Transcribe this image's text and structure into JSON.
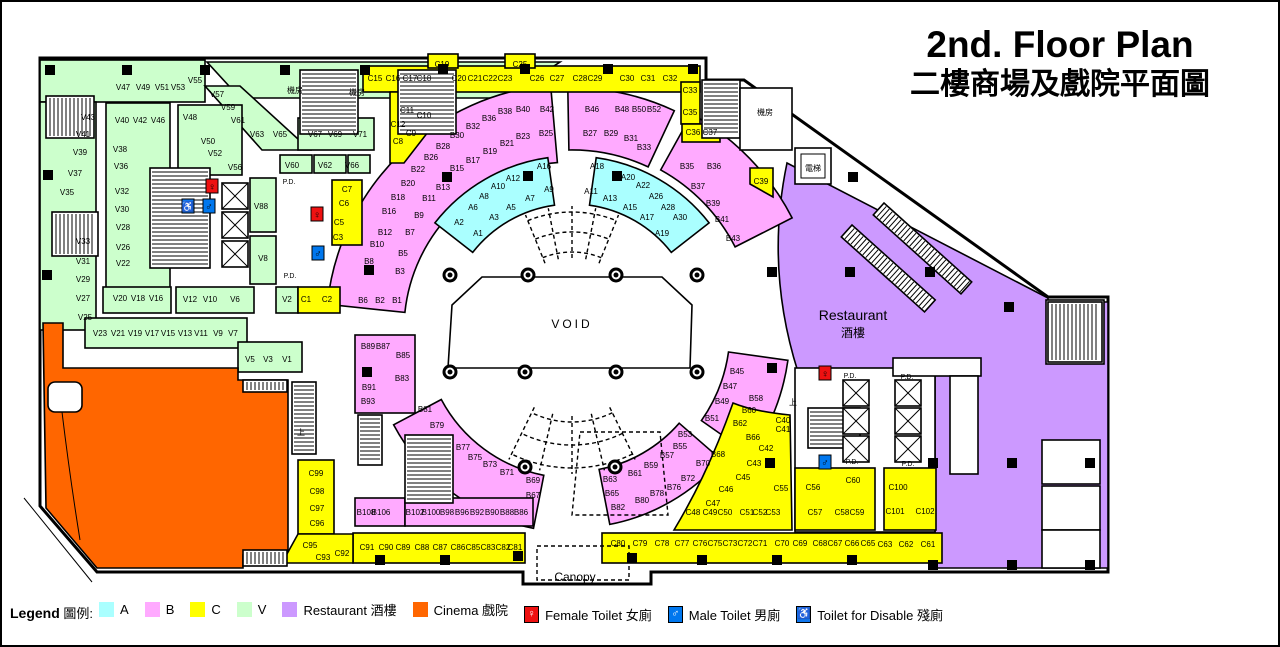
{
  "title": {
    "line1": "2nd. Floor Plan",
    "line2": "二樓商場及戲院平面圖"
  },
  "plan": {
    "void_label": "VOID",
    "canopy_label": "Canopy",
    "restaurant_en": "Restaurant",
    "restaurant_zh": "酒樓",
    "pd_text": "P.D."
  },
  "colors": {
    "a_cyan": "#aaffff",
    "b_pink": "#ffaaff",
    "c_yellow": "#ffff00",
    "v_green": "#ccffcc",
    "restaurant_purple": "#cc99ff",
    "cinema_orange": "#ff6600",
    "female_red": "#ee1111",
    "male_blue": "#0077ee",
    "disabled_blue": "#1177ee"
  },
  "legend": {
    "title_en": "Legend",
    "title_zh": "圖例:",
    "items": [
      {
        "label": "A",
        "type": "color",
        "swatch": "#aaffff"
      },
      {
        "label": "B",
        "type": "color",
        "swatch": "#ffaaff"
      },
      {
        "label": "C",
        "type": "color",
        "swatch": "#ffff00"
      },
      {
        "label": "V",
        "type": "color",
        "swatch": "#ccffcc"
      },
      {
        "label": "Restaurant 酒樓",
        "type": "color",
        "swatch": "#cc99ff"
      },
      {
        "label": "Cinema 戲院",
        "type": "color",
        "swatch": "#ff6600"
      },
      {
        "label": "Female Toilet 女廁",
        "type": "icon",
        "icon": "female-toilet",
        "swatch": "#ee1111"
      },
      {
        "label": "Male Toilet 男廁",
        "type": "icon",
        "icon": "male-toilet",
        "swatch": "#0077ee"
      },
      {
        "label": "Toilet for Disable 殘廁",
        "type": "icon",
        "icon": "disabled-toilet",
        "swatch": "#1177ee"
      }
    ]
  },
  "unit_labels": {
    "V": [
      [
        "V43",
        88,
        117
      ],
      [
        "V41",
        83,
        134
      ],
      [
        "V39",
        80,
        152
      ],
      [
        "V37",
        75,
        173
      ],
      [
        "V35",
        67,
        192
      ],
      [
        "V33",
        83,
        241
      ],
      [
        "V31",
        83,
        261
      ],
      [
        "V29",
        83,
        279
      ],
      [
        "V27",
        83,
        298
      ],
      [
        "V25",
        85,
        317
      ],
      [
        "V47",
        123,
        87
      ],
      [
        "V49",
        143,
        87
      ],
      [
        "V51",
        162,
        87
      ],
      [
        "V53",
        178,
        87
      ],
      [
        "V55",
        195,
        80
      ],
      [
        "V57",
        217,
        94
      ],
      [
        "V59",
        228,
        107
      ],
      [
        "V61",
        238,
        120
      ],
      [
        "V63",
        257,
        134
      ],
      [
        "V65",
        280,
        134
      ],
      [
        "V67",
        315,
        134
      ],
      [
        "V69",
        335,
        134
      ],
      [
        "V71",
        360,
        134
      ],
      [
        "V40",
        122,
        120
      ],
      [
        "V42",
        140,
        120
      ],
      [
        "V46",
        158,
        120
      ],
      [
        "V48",
        190,
        117
      ],
      [
        "V50",
        208,
        141
      ],
      [
        "V52",
        215,
        153
      ],
      [
        "V56",
        235,
        167
      ],
      [
        "V38",
        120,
        149
      ],
      [
        "V36",
        121,
        166
      ],
      [
        "V32",
        122,
        191
      ],
      [
        "V30",
        122,
        209
      ],
      [
        "V28",
        123,
        227
      ],
      [
        "V26",
        123,
        247
      ],
      [
        "V22",
        123,
        263
      ],
      [
        "V20",
        120,
        298
      ],
      [
        "V18",
        138,
        298
      ],
      [
        "V16",
        156,
        298
      ],
      [
        "V12",
        190,
        299
      ],
      [
        "V10",
        210,
        299
      ],
      [
        "V6",
        235,
        299
      ],
      [
        "V2",
        287,
        299
      ],
      [
        "V23",
        100,
        333
      ],
      [
        "V21",
        118,
        333
      ],
      [
        "V19",
        135,
        333
      ],
      [
        "V17",
        152,
        333
      ],
      [
        "V15",
        168,
        333
      ],
      [
        "V13",
        185,
        333
      ],
      [
        "V11",
        201,
        333
      ],
      [
        "V9",
        218,
        333
      ],
      [
        "V7",
        233,
        333
      ],
      [
        "V5",
        250,
        359
      ],
      [
        "V3",
        268,
        359
      ],
      [
        "V1",
        287,
        359
      ],
      [
        "V60",
        292,
        165
      ],
      [
        "V62",
        325,
        165
      ],
      [
        "V66",
        352,
        165
      ],
      [
        "V88",
        261,
        206
      ],
      [
        "V8",
        263,
        258
      ]
    ],
    "A": [
      [
        "A1",
        478,
        233
      ],
      [
        "A2",
        459,
        222
      ],
      [
        "A3",
        494,
        217
      ],
      [
        "A5",
        511,
        207
      ],
      [
        "A6",
        473,
        207
      ],
      [
        "A7",
        530,
        198
      ],
      [
        "A8",
        484,
        196
      ],
      [
        "A9",
        549,
        189
      ],
      [
        "A10",
        498,
        186
      ],
      [
        "A12",
        513,
        178
      ],
      [
        "A16",
        544,
        166
      ],
      [
        "A18",
        597,
        166
      ],
      [
        "A20",
        628,
        177
      ],
      [
        "A22",
        643,
        185
      ],
      [
        "A26",
        656,
        196
      ],
      [
        "A28",
        668,
        207
      ],
      [
        "A30",
        680,
        217
      ],
      [
        "A11",
        591,
        191
      ],
      [
        "A13",
        610,
        198
      ],
      [
        "A15",
        630,
        207
      ],
      [
        "A17",
        647,
        217
      ],
      [
        "A19",
        662,
        233
      ]
    ],
    "B": [
      [
        "B1",
        397,
        300
      ],
      [
        "B2",
        380,
        300
      ],
      [
        "B6",
        363,
        300
      ],
      [
        "B3",
        400,
        271
      ],
      [
        "B5",
        403,
        253
      ],
      [
        "B7",
        410,
        232
      ],
      [
        "B9",
        419,
        215
      ],
      [
        "B11",
        429,
        198
      ],
      [
        "B13",
        443,
        187
      ],
      [
        "B15",
        457,
        168
      ],
      [
        "B17",
        473,
        160
      ],
      [
        "B19",
        490,
        151
      ],
      [
        "B21",
        507,
        143
      ],
      [
        "B23",
        523,
        136
      ],
      [
        "B25",
        546,
        133
      ],
      [
        "B8",
        369,
        261
      ],
      [
        "B10",
        377,
        244
      ],
      [
        "B12",
        385,
        232
      ],
      [
        "B16",
        389,
        211
      ],
      [
        "B18",
        398,
        197
      ],
      [
        "B20",
        408,
        183
      ],
      [
        "B22",
        418,
        169
      ],
      [
        "B26",
        431,
        157
      ],
      [
        "B28",
        443,
        146
      ],
      [
        "B30",
        457,
        135
      ],
      [
        "B32",
        473,
        126
      ],
      [
        "B36",
        489,
        118
      ],
      [
        "B38",
        505,
        111
      ],
      [
        "B40",
        523,
        109
      ],
      [
        "B42",
        547,
        109
      ],
      [
        "B46",
        592,
        109
      ],
      [
        "B48",
        622,
        109
      ],
      [
        "B50",
        639,
        109
      ],
      [
        "B52",
        654,
        109
      ],
      [
        "B27",
        590,
        133
      ],
      [
        "B29",
        611,
        133
      ],
      [
        "B31",
        631,
        138
      ],
      [
        "B33",
        644,
        147
      ],
      [
        "B35",
        687,
        166
      ],
      [
        "B36",
        714,
        166
      ],
      [
        "B37",
        698,
        186
      ],
      [
        "B39",
        713,
        203
      ],
      [
        "B41",
        722,
        219
      ],
      [
        "B43",
        733,
        238
      ],
      [
        "B45",
        737,
        371
      ],
      [
        "B47",
        730,
        386
      ],
      [
        "B49",
        722,
        401
      ],
      [
        "B51",
        712,
        418
      ],
      [
        "B58",
        756,
        398
      ],
      [
        "B60",
        749,
        410
      ],
      [
        "B62",
        740,
        423
      ],
      [
        "B66",
        753,
        437
      ],
      [
        "B53",
        685,
        434
      ],
      [
        "B55",
        680,
        446
      ],
      [
        "B57",
        667,
        455
      ],
      [
        "B59",
        651,
        465
      ],
      [
        "B61",
        635,
        473
      ],
      [
        "B63",
        610,
        479
      ],
      [
        "B65",
        612,
        493
      ],
      [
        "B68",
        718,
        454
      ],
      [
        "B70",
        703,
        463
      ],
      [
        "B72",
        688,
        478
      ],
      [
        "B76",
        674,
        487
      ],
      [
        "B78",
        657,
        493
      ],
      [
        "B80",
        642,
        500
      ],
      [
        "B82",
        618,
        507
      ],
      [
        "B67",
        533,
        495
      ],
      [
        "B69",
        533,
        480
      ],
      [
        "B71",
        507,
        472
      ],
      [
        "B73",
        490,
        464
      ],
      [
        "B75",
        475,
        457
      ],
      [
        "B77",
        463,
        447
      ],
      [
        "B79",
        437,
        425
      ],
      [
        "B81",
        425,
        409
      ],
      [
        "B86",
        521,
        512
      ],
      [
        "B88",
        507,
        512
      ],
      [
        "B90",
        492,
        512
      ],
      [
        "B92",
        477,
        512
      ],
      [
        "B96",
        462,
        512
      ],
      [
        "B98",
        447,
        512
      ],
      [
        "B100",
        431,
        512
      ],
      [
        "B102",
        415,
        512
      ],
      [
        "B106",
        381,
        512
      ],
      [
        "B108",
        366,
        512
      ],
      [
        "B83",
        402,
        378
      ],
      [
        "B85",
        403,
        355
      ],
      [
        "B87",
        383,
        346
      ],
      [
        "B89",
        368,
        346
      ],
      [
        "B91",
        369,
        387
      ],
      [
        "B93",
        368,
        401
      ]
    ],
    "C": [
      [
        "C15",
        375,
        78
      ],
      [
        "C16",
        393,
        78
      ],
      [
        "C17",
        410,
        78
      ],
      [
        "C18",
        424,
        78
      ],
      [
        "C19",
        442,
        64
      ],
      [
        "C20",
        459,
        78
      ],
      [
        "C21",
        475,
        78
      ],
      [
        "C22",
        490,
        78
      ],
      [
        "C23",
        505,
        78
      ],
      [
        "C25",
        520,
        64
      ],
      [
        "C26",
        537,
        78
      ],
      [
        "C27",
        557,
        78
      ],
      [
        "C28",
        580,
        78
      ],
      [
        "C29",
        595,
        78
      ],
      [
        "C30",
        627,
        78
      ],
      [
        "C31",
        648,
        78
      ],
      [
        "C32",
        670,
        78
      ],
      [
        "C33",
        690,
        90
      ],
      [
        "C35",
        690,
        112
      ],
      [
        "C36",
        693,
        132
      ],
      [
        "C37",
        710,
        132
      ],
      [
        "C11",
        407,
        110
      ],
      [
        "C10",
        424,
        115
      ],
      [
        "C12",
        398,
        124
      ],
      [
        "C9",
        411,
        133
      ],
      [
        "C8",
        398,
        141
      ],
      [
        "C7",
        347,
        189
      ],
      [
        "C6",
        344,
        203
      ],
      [
        "C5",
        339,
        222
      ],
      [
        "C3",
        338,
        237
      ],
      [
        "C1",
        306,
        299
      ],
      [
        "C2",
        327,
        299
      ],
      [
        "C39",
        761,
        181
      ],
      [
        "C40",
        783,
        420
      ],
      [
        "C41",
        783,
        429
      ],
      [
        "C42",
        766,
        448
      ],
      [
        "C43",
        754,
        463
      ],
      [
        "C45",
        743,
        477
      ],
      [
        "C46",
        726,
        489
      ],
      [
        "C47",
        713,
        503
      ],
      [
        "C48",
        693,
        512
      ],
      [
        "C49",
        710,
        512
      ],
      [
        "C50",
        725,
        512
      ],
      [
        "C51",
        747,
        512
      ],
      [
        "C52",
        760,
        512
      ],
      [
        "C53",
        773,
        512
      ],
      [
        "C55",
        781,
        488
      ],
      [
        "C56",
        813,
        487
      ],
      [
        "C57",
        815,
        512
      ],
      [
        "C58",
        842,
        512
      ],
      [
        "C59",
        857,
        512
      ],
      [
        "C60",
        853,
        480
      ],
      [
        "C100",
        898,
        487
      ],
      [
        "C101",
        895,
        511
      ],
      [
        "C102",
        925,
        511
      ],
      [
        "C99",
        316,
        473
      ],
      [
        "C98",
        317,
        491
      ],
      [
        "C97",
        317,
        508
      ],
      [
        "C96",
        317,
        523
      ],
      [
        "C95",
        310,
        545
      ],
      [
        "C93",
        323,
        557
      ],
      [
        "C92",
        342,
        553
      ],
      [
        "C91",
        367,
        547
      ],
      [
        "C90",
        386,
        547
      ],
      [
        "C89",
        403,
        547
      ],
      [
        "C88",
        422,
        547
      ],
      [
        "C87",
        440,
        547
      ],
      [
        "C86",
        458,
        547
      ],
      [
        "C85",
        473,
        547
      ],
      [
        "C83",
        488,
        547
      ],
      [
        "C82",
        503,
        547
      ],
      [
        "C81",
        515,
        547
      ],
      [
        "C80",
        618,
        543
      ],
      [
        "C79",
        640,
        543
      ],
      [
        "C78",
        662,
        543
      ],
      [
        "C77",
        682,
        543
      ],
      [
        "C76",
        700,
        543
      ],
      [
        "C75",
        715,
        543
      ],
      [
        "C73",
        730,
        543
      ],
      [
        "C72",
        745,
        543
      ],
      [
        "C71",
        760,
        543
      ],
      [
        "C70",
        782,
        543
      ],
      [
        "C69",
        800,
        543
      ],
      [
        "C68",
        820,
        543
      ],
      [
        "C67",
        835,
        543
      ],
      [
        "C66",
        852,
        543
      ],
      [
        "C65",
        868,
        543
      ],
      [
        "C63",
        885,
        544
      ],
      [
        "C62",
        906,
        544
      ],
      [
        "C61",
        928,
        544
      ]
    ]
  },
  "room_labels": [
    [
      "機房",
      295,
      90
    ],
    [
      "機房",
      357,
      92
    ],
    [
      "機房",
      765,
      112
    ],
    [
      "電梯",
      813,
      168
    ],
    [
      "上",
      793,
      402
    ],
    [
      "上",
      301,
      432
    ]
  ],
  "pd_positions": [
    [
      289,
      182
    ],
    [
      290,
      276
    ],
    [
      850,
      376
    ],
    [
      907,
      377
    ],
    [
      852,
      462
    ],
    [
      908,
      464
    ]
  ],
  "toilets": [
    {
      "kind": "female",
      "x": 212,
      "y": 186
    },
    {
      "kind": "disabled",
      "x": 188,
      "y": 206
    },
    {
      "kind": "male",
      "x": 209,
      "y": 206
    },
    {
      "kind": "female",
      "x": 317,
      "y": 214
    },
    {
      "kind": "male",
      "x": 318,
      "y": 253
    },
    {
      "kind": "female",
      "x": 825,
      "y": 373
    },
    {
      "kind": "male",
      "x": 825,
      "y": 462
    }
  ]
}
